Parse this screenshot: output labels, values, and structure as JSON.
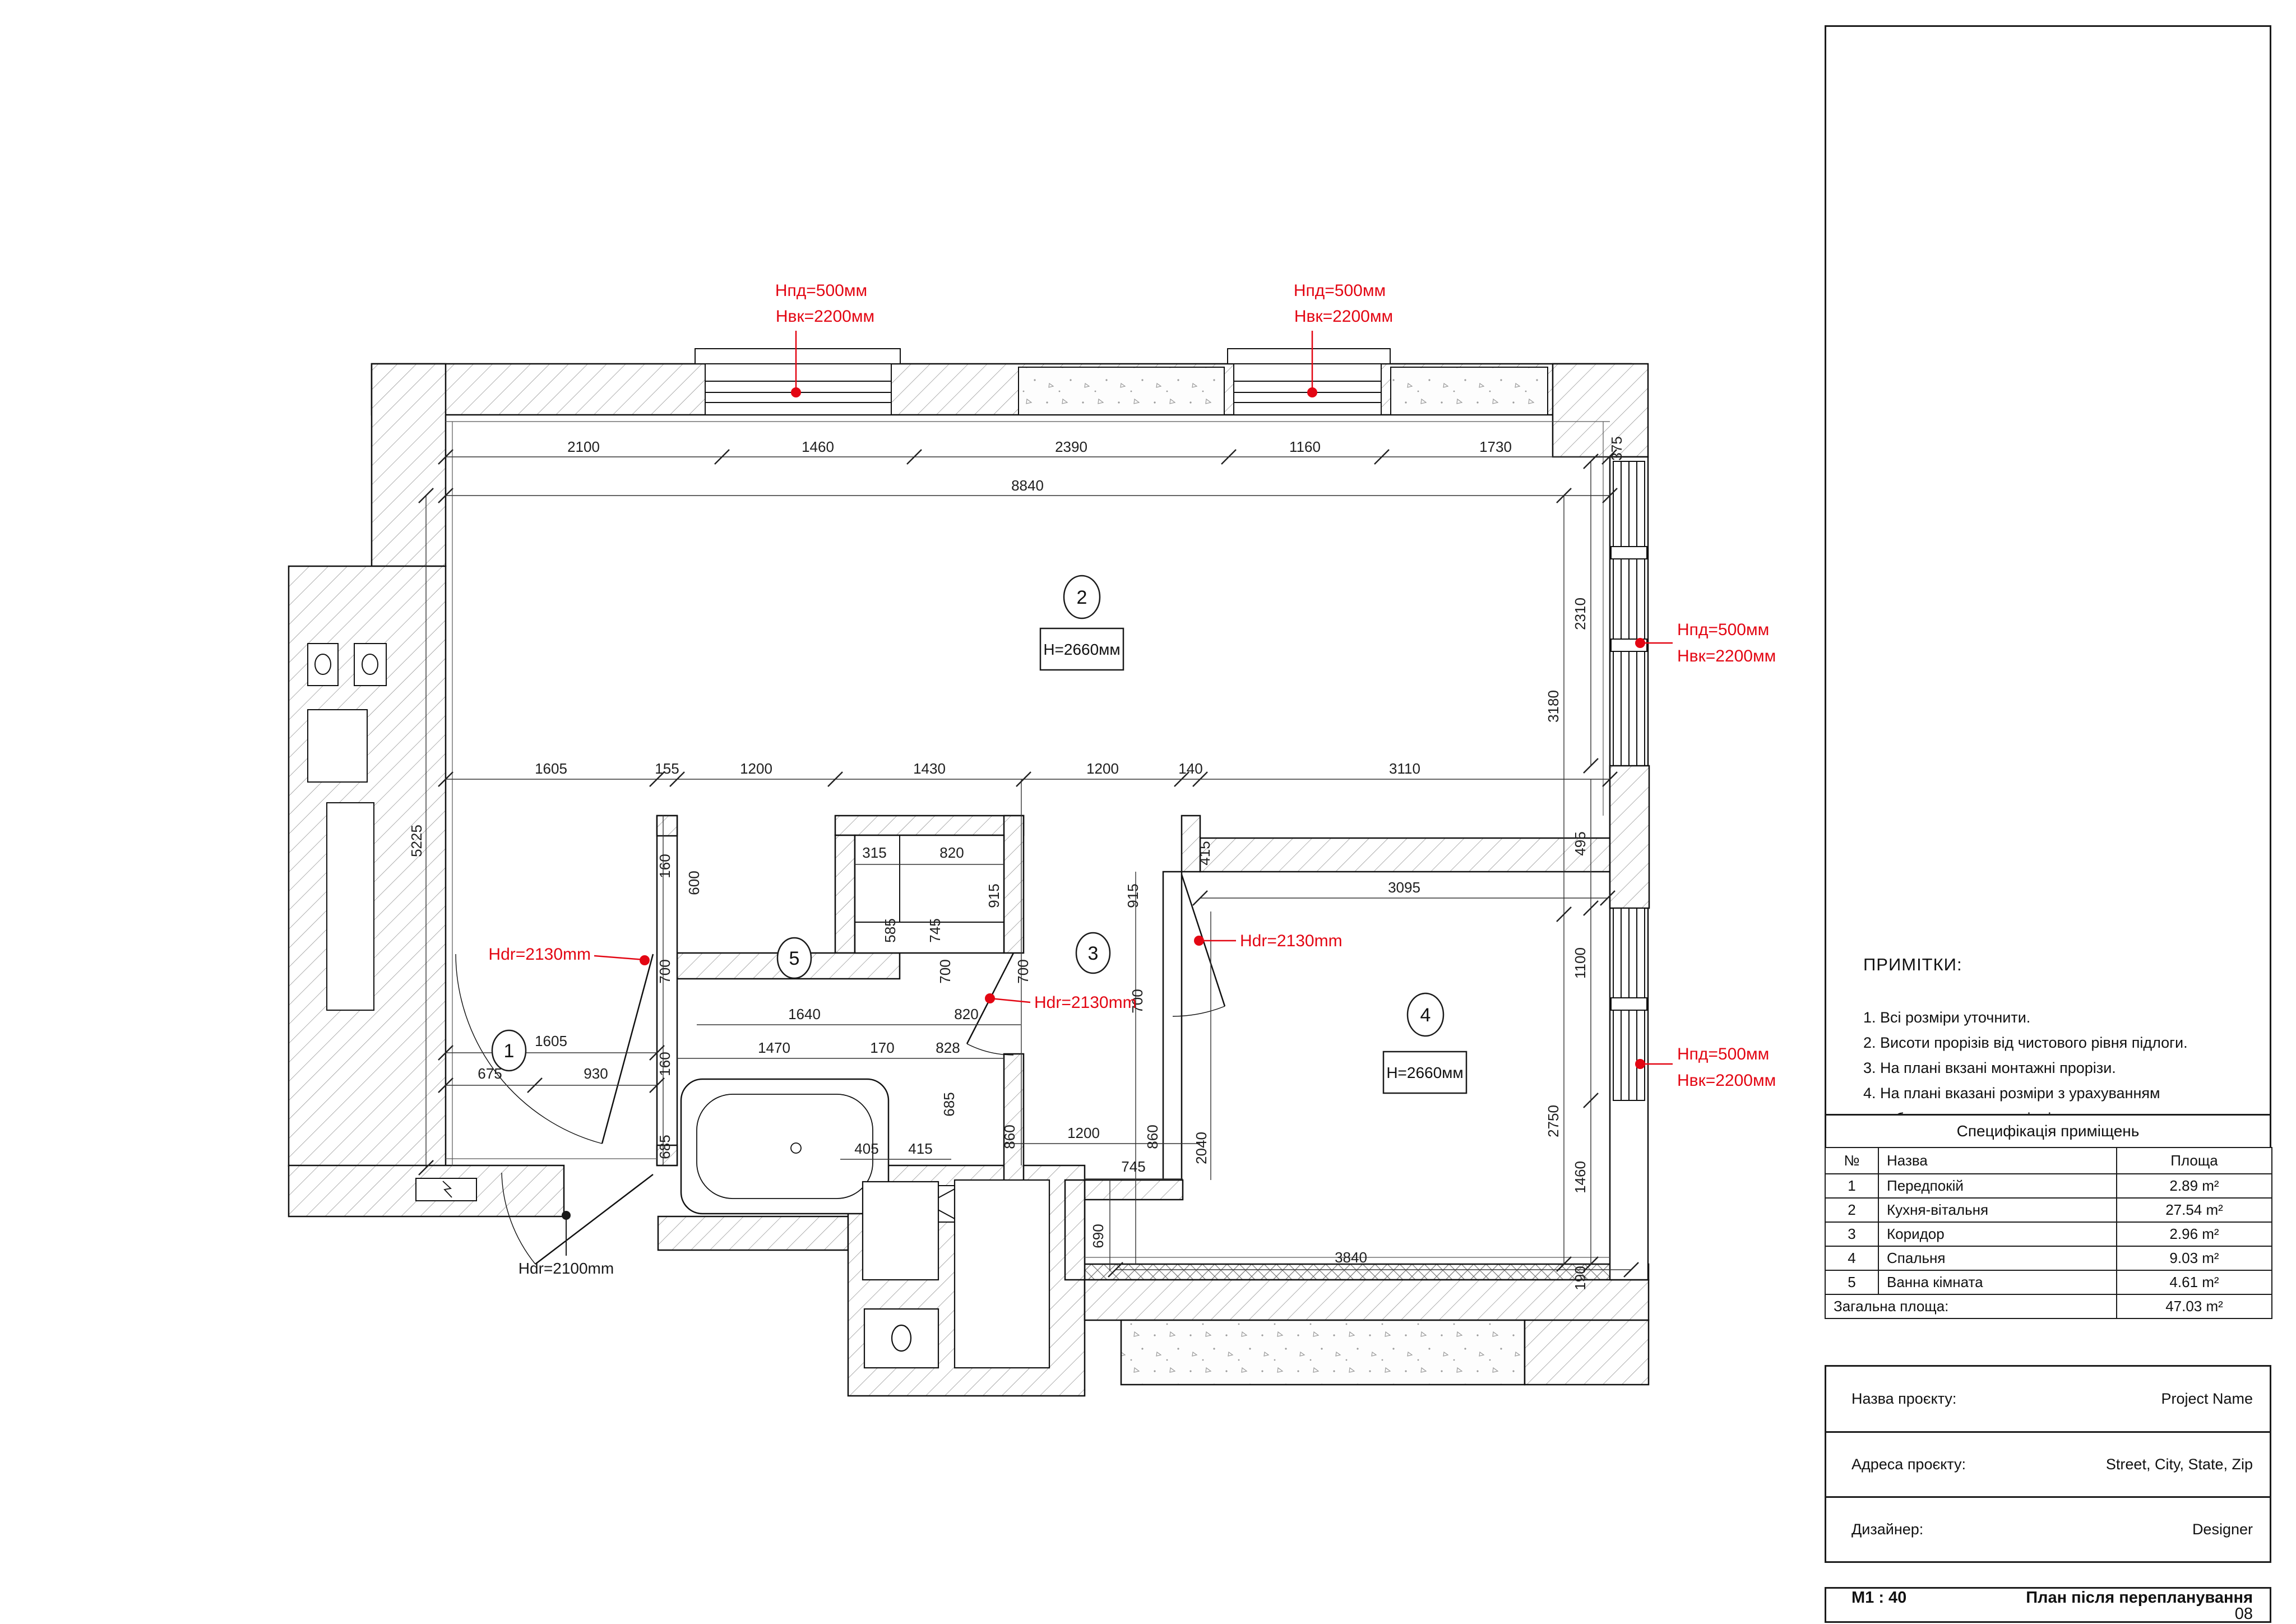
{
  "plan": {
    "rooms": [
      "1",
      "2",
      "3",
      "4",
      "5"
    ],
    "h2660": "H=2660мм",
    "red": {
      "hpd": "Hпд=500мм",
      "hvk": "Hвк=2200мм",
      "hdr2130": "Hdr=2130mm",
      "hdr2100": "Hdr=2100mm"
    },
    "dims": {
      "top": [
        "2100",
        "1460",
        "2390",
        "1160",
        "1730",
        "375",
        "8840"
      ],
      "left": [
        "5225"
      ],
      "mid": [
        "1605",
        "155",
        "1200",
        "1430",
        "1200",
        "140",
        "3110"
      ],
      "right": [
        "3180",
        "2310",
        "495",
        "1100",
        "2750",
        "1460",
        "190"
      ],
      "bedroom": [
        "3095",
        "415",
        "915",
        "915",
        "2040",
        "745",
        "690",
        "3840",
        "1200",
        "860",
        "860"
      ],
      "bath": [
        "600",
        "315",
        "820",
        "585",
        "745",
        "700",
        "700",
        "700",
        "700",
        "160",
        "1640",
        "820",
        "160",
        "1470",
        "170",
        "828",
        "685",
        "685",
        "405",
        "415"
      ],
      "hall": [
        "1605",
        "675",
        "930"
      ]
    },
    "colors": {
      "red": "#e30613",
      "line": "#1a1a1a"
    }
  },
  "panel": {
    "notes": {
      "title": "ПРИМІТКИ:",
      "items": [
        "1. Всі розміри уточнити.",
        "2. Висоти прорізів від чистового рівня підлоги.",
        "3. На плані вкзані монтажні прорізи.",
        "4. На плані вказані розміри з урахуванням",
        "оздоблювальних матеріалів"
      ]
    },
    "spec": {
      "title": "Специфікація приміщень",
      "headers": [
        "№",
        "Назва",
        "Площа"
      ],
      "rows": [
        [
          "1",
          "Передпокій",
          "2.89 m²"
        ],
        [
          "2",
          "Кухня-вітальня",
          "27.54 m²"
        ],
        [
          "3",
          "Коридор",
          "2.96 m²"
        ],
        [
          "4",
          "Спальня",
          "9.03 m²"
        ],
        [
          "5",
          "Ванна кімната",
          "4.61 m²"
        ]
      ],
      "total_label": "Загальна площа:",
      "total_value": "47.03 m²"
    },
    "project": {
      "rows": [
        {
          "label": "Назва проєкту:",
          "value": "Project Name"
        },
        {
          "label": "Адреса проєкту:",
          "value": "Street, City, State, Zip"
        },
        {
          "label": "Дизайнер:",
          "value": "Designer"
        }
      ]
    },
    "titlebar": {
      "scale": "M1 : 40",
      "name": "План після перепланування",
      "page": "08"
    }
  }
}
